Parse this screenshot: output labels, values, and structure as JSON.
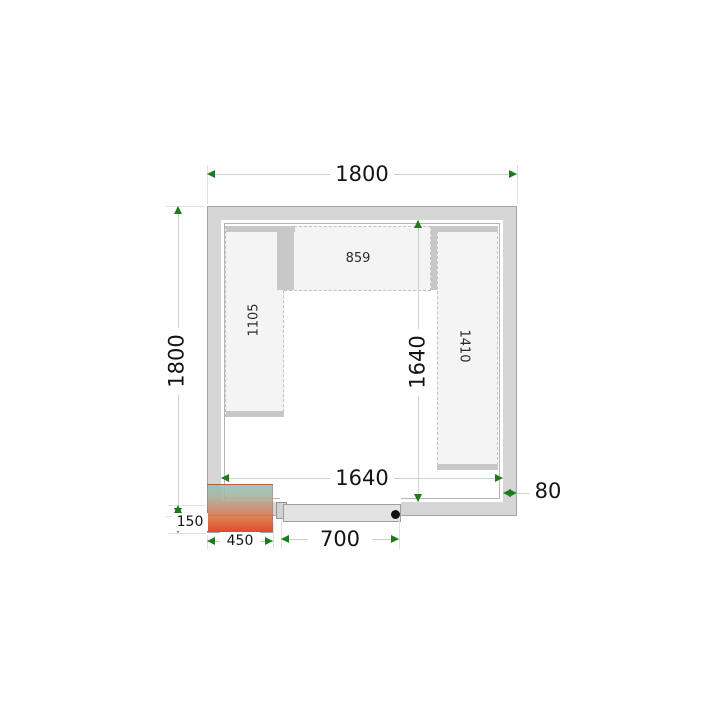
{
  "diagram": {
    "type": "cold-room-floor-plan-top-view",
    "dimensions": {
      "outer_width": "1800",
      "outer_height": "1800",
      "inner_width": "1640",
      "inner_height": "1640",
      "wall_thickness": "80",
      "unit_protrusion": "150",
      "unit_width": "450",
      "door_width": "700"
    },
    "shelves": {
      "left_length": "1105",
      "top_length": "859",
      "right_length": "1410"
    },
    "colors": {
      "wall_fill": "#d6d6d6",
      "wall_edge": "#a5a5a5",
      "shelf_fill": "#f4f4f4",
      "shelf_edge_dashed": "#c2c2c2",
      "support_bar": "#c8c8c8",
      "dimension_arrow": "#1d7a1d",
      "dimension_line": "#c7d6c7",
      "door_fill": "#e3e3e3",
      "unit_gradient_top": "#8cc4bc",
      "unit_gradient_bottom": "#de330c",
      "handle_dot": "#111111"
    }
  }
}
